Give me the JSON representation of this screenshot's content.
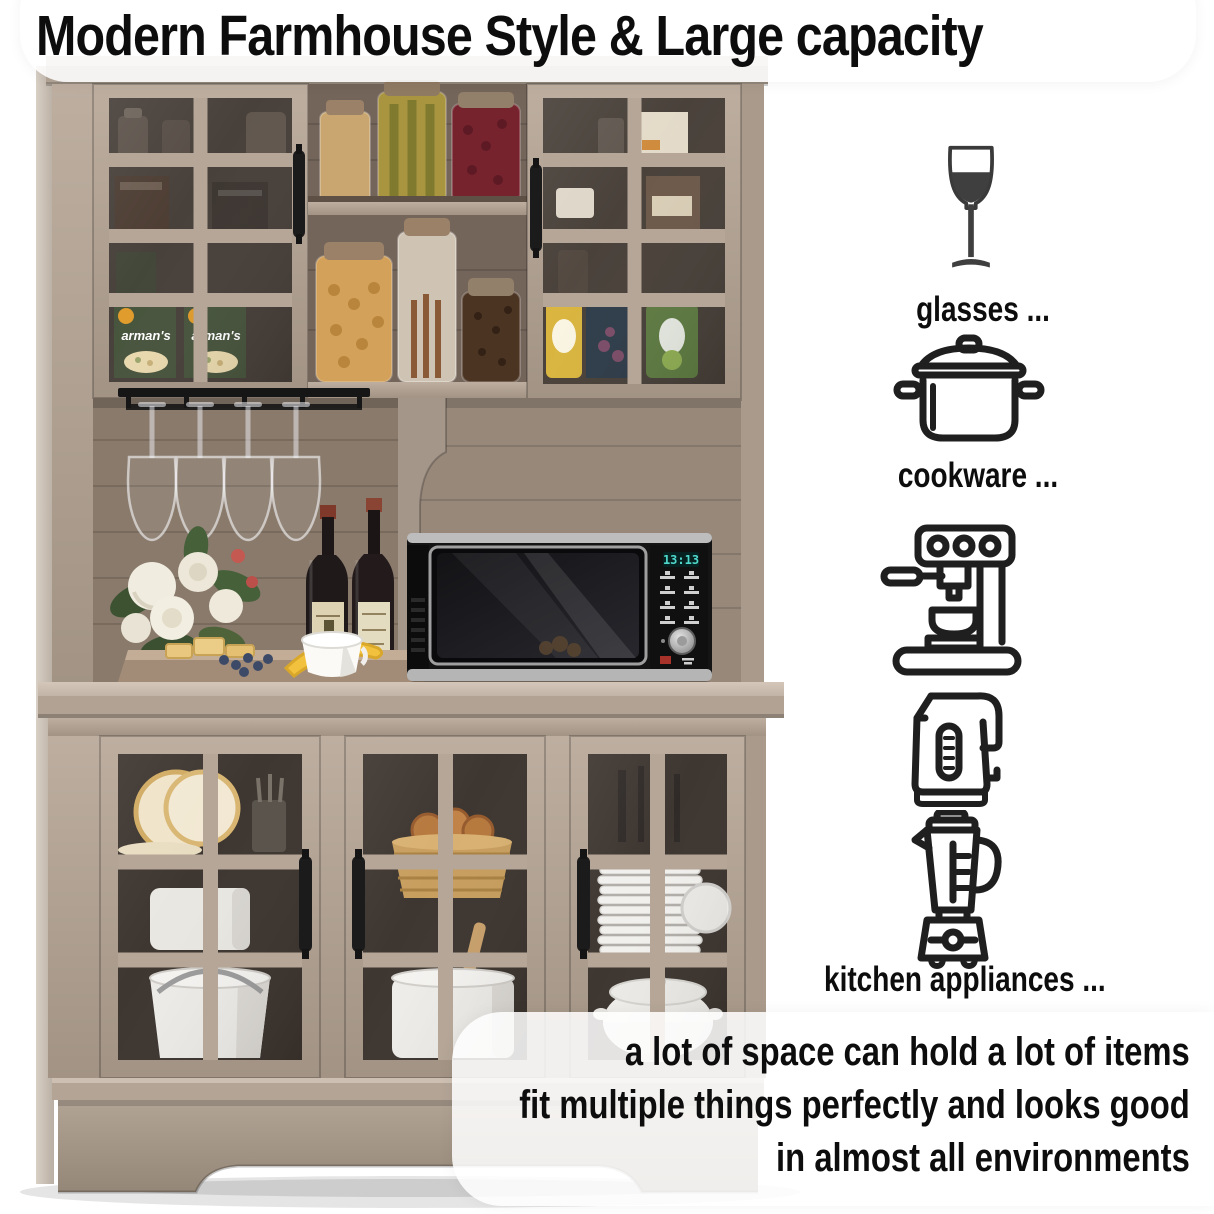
{
  "title": "Modern Farmhouse Style & Large capacity",
  "features": [
    {
      "id": "glasses",
      "icon": "wine-glass-icon",
      "label": "glasses ..."
    },
    {
      "id": "cookware",
      "icon": "cooking-pot-icon",
      "label": "cookware ..."
    },
    {
      "id": "kitchen-appliances",
      "icons": [
        "espresso-machine-icon",
        "electric-kettle-icon",
        "blender-icon"
      ],
      "label": "kitchen appliances ..."
    }
  ],
  "caption": {
    "line1": "a lot of space can hold a lot of items",
    "line2": "fit multiple things perfectly and looks good",
    "line3": "in almost all environments"
  },
  "photo": {
    "microwave_clock": "13:13",
    "package_text": "arman's"
  },
  "colors": {
    "text": "#101010",
    "icon_stroke": "#1f1f1f",
    "wood_light": "#b7a89a",
    "wood_dark": "#8a7b6d",
    "microwave_clock": "#4fd8cc"
  }
}
